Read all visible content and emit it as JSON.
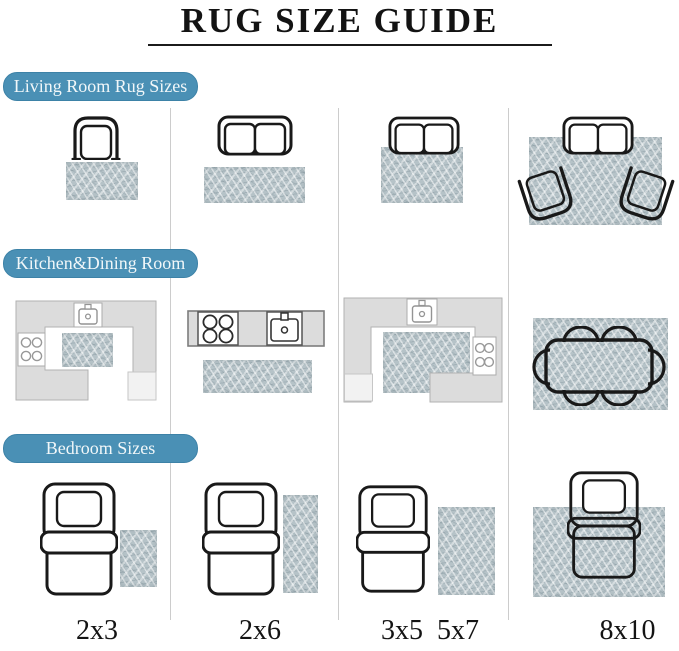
{
  "title": "RUG SIZE GUIDE",
  "sections": {
    "living": {
      "label": "Living Room Rug Sizes"
    },
    "kitchen": {
      "label": "Kitchen&Dining Room"
    },
    "bedroom": {
      "label": "Bedroom Sizes"
    }
  },
  "columns": [
    {
      "size_label": "2x3"
    },
    {
      "size_label": "2x6"
    },
    {
      "size_label": "3x5  5x7"
    },
    {
      "size_label": "8x10"
    }
  ],
  "colors": {
    "banner_blue": "#4a90b5",
    "banner_text": "#f1f7f9",
    "rug_base": "#b6c3c8",
    "counter_gray": "#dcdcdc",
    "furniture_outline": "#191919"
  },
  "icons": {
    "armchair": "top-view outline shape",
    "loveseat": "top-view outline shape",
    "dining_table": "rounded rectangle with six chair arcs",
    "bed": "top-view outline with pillow and blanket band",
    "stove": "square with four burner circles",
    "sink": "basin with faucet and drain",
    "rug": "textured blue-gray rectangle"
  }
}
